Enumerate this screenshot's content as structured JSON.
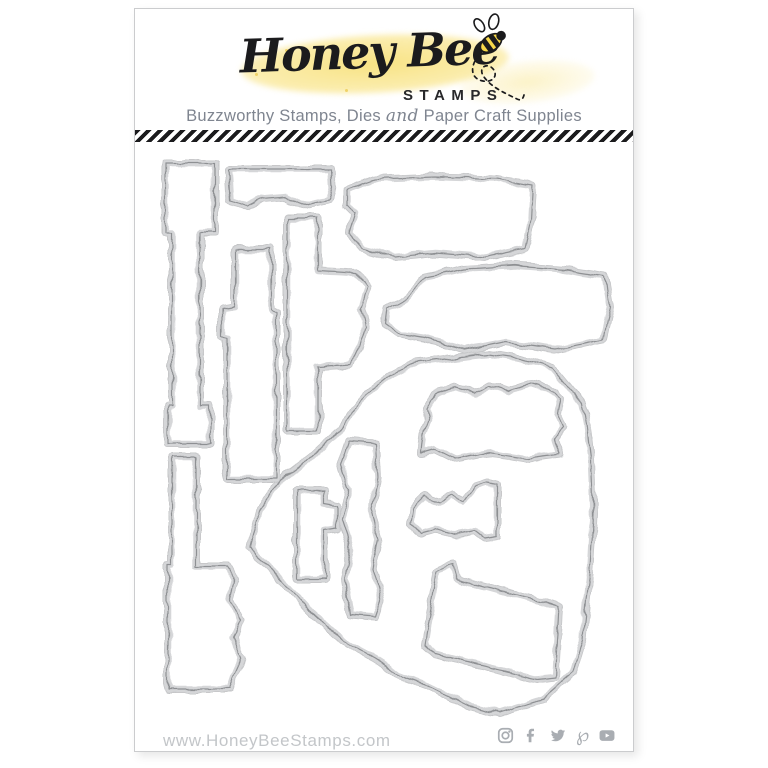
{
  "brand": {
    "script_name": "Honey Bee",
    "word_mark": "STAMPS"
  },
  "tagline": {
    "part1": "Buzzworthy Stamps, Dies",
    "conjunction": "and",
    "part2": "Paper Craft Supplies"
  },
  "footer": {
    "website": "www.HoneyBeeStamps.com",
    "social_icons": [
      "instagram-icon",
      "facebook-icon",
      "twitter-icon",
      "pinterest-icon",
      "youtube-icon"
    ]
  },
  "logo_icons": [
    "bee-icon",
    "dashed-flight-trail",
    "yellow-watercolor-swash"
  ],
  "die_pieces": [
    "tall-strip-with-head",
    "small-wavy-banner",
    "large-cloud-banner",
    "vertical-strip",
    "banner-with-side-tab",
    "wide-cloud-banner",
    "large-heart-outline",
    "cloud-label",
    "small-bar-with-nub",
    "wavy-vertical-trim",
    "small-cloud-trim",
    "slanted-tag",
    "wide-bottom-strip"
  ],
  "visible_die_piece_count": 13,
  "colors": {
    "accent_yellow": "#f8e384",
    "logo_black": "#1b1b1d",
    "die_metal": "#d5d6d8",
    "die_cut_line": "#8e9093",
    "divider_black": "#1b1b1d",
    "tagline_gray": "#7f8590",
    "footer_text_gray": "#c3c6c9",
    "social_icon_gray": "#a9adb2",
    "card_border": "#cbccce"
  }
}
